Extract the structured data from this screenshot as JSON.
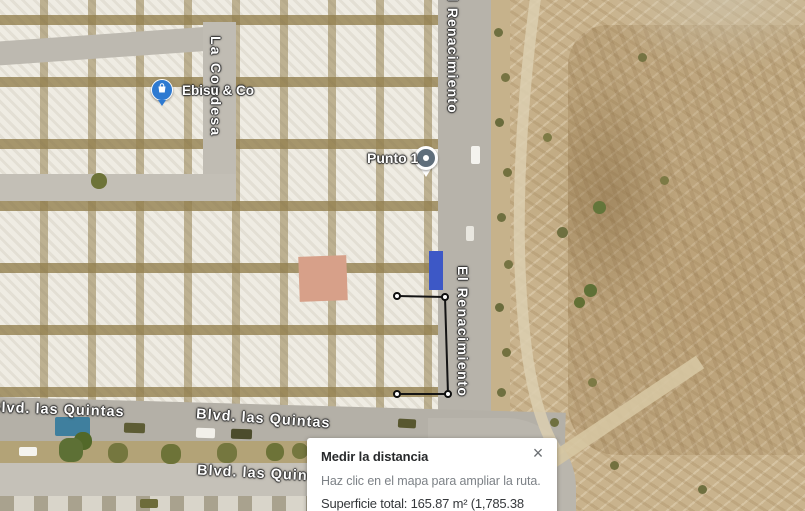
{
  "map": {
    "street_labels": [
      {
        "id": "el-renacimiento-top",
        "text": "El Renacimiento"
      },
      {
        "id": "el-renacimiento-mid",
        "text": "El Renacimiento"
      },
      {
        "id": "la-condesa",
        "text": "La Condesa"
      },
      {
        "id": "blvd-las-quintas-left",
        "text": "Blvd. las Quintas"
      },
      {
        "id": "blvd-las-quintas-right",
        "text": "Blvd. las Quintas"
      },
      {
        "id": "blvd-las-quintas-bottom",
        "text": "Blvd. las Quintas"
      }
    ],
    "markers": {
      "business": {
        "label": "Ebisu & Co",
        "icon": "shopping-bag-icon",
        "color": "#2e7ad1"
      },
      "measure_point": {
        "label": "Punto 1",
        "icon": "circle-pin-icon",
        "color": "#5f6e7b"
      }
    },
    "measurement": {
      "line_color": "#141414",
      "vertex_color": "#ffffff",
      "points_px": [
        [
          397,
          296
        ],
        [
          445,
          297
        ],
        [
          448,
          394
        ],
        [
          397,
          394
        ]
      ],
      "segments": [
        [
          0,
          1
        ],
        [
          1,
          2
        ],
        [
          2,
          3
        ]
      ]
    }
  },
  "measure_panel": {
    "title": "Medir la distancia",
    "subtitle": "Haz clic en el mapa para ampliar la ruta.",
    "total": "Superficie total: 165.87 m² (1,785.38 pies²)",
    "close_icon": "×"
  }
}
